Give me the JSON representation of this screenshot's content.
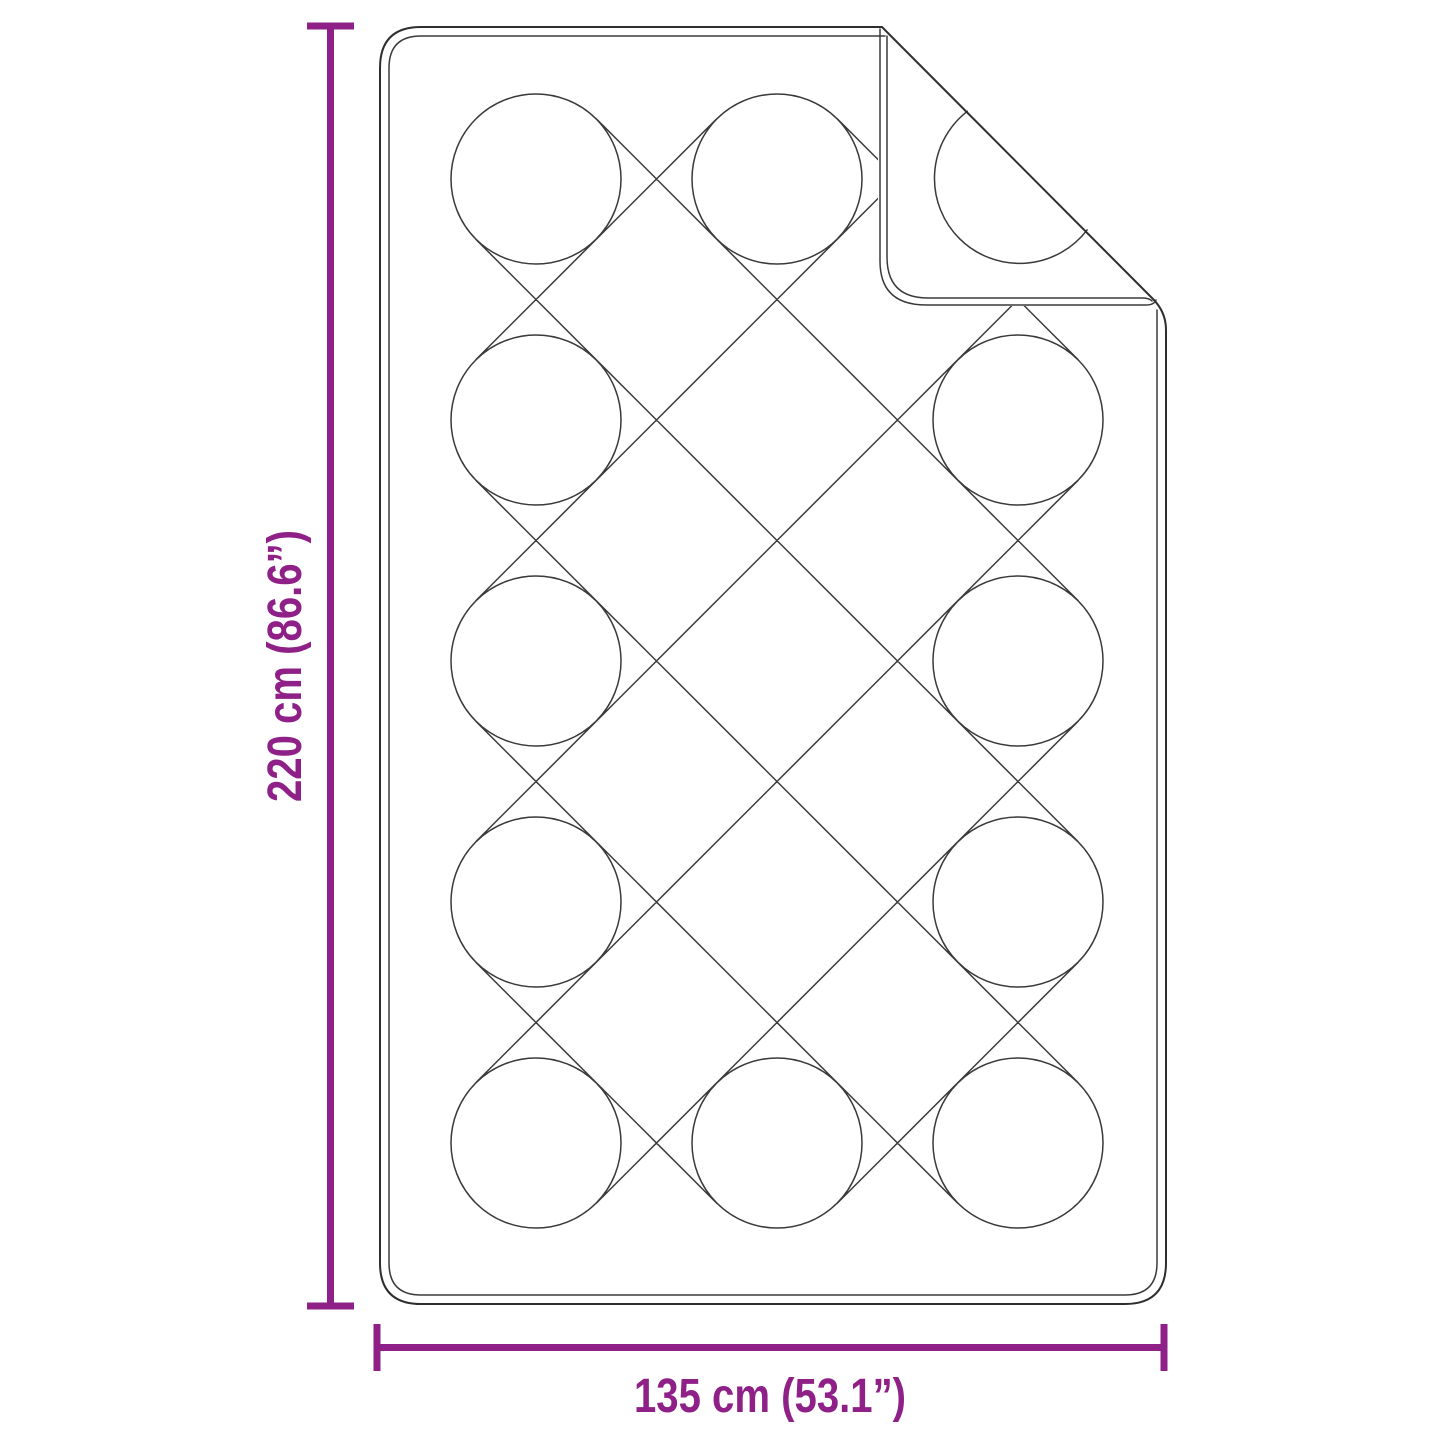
{
  "diagram": {
    "figure": "quilted-blanket-dimension-diagram",
    "background_color": "#ffffff",
    "drawing_line_color": "#3a3a3a",
    "accent_color": "#8e2088",
    "dimensions": {
      "height": {
        "label": "220 cm (86.6”)"
      },
      "width": {
        "label": "135 cm (53.1”)"
      }
    }
  }
}
